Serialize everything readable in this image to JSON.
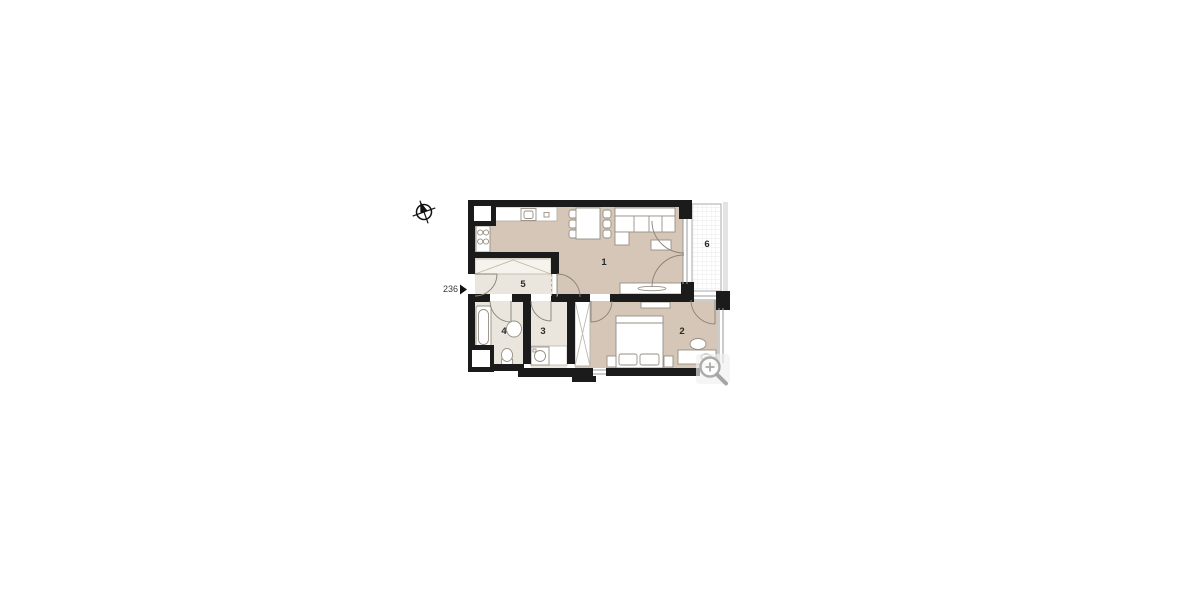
{
  "page": {
    "type": "apartment-floor-plan-viewer",
    "background_color": "#ffffff"
  },
  "floor_plan": {
    "unit_number": "236",
    "entry_marker": "right-filled-triangle",
    "rooms": [
      {
        "label": "1",
        "name": "living-room-with-kitchen"
      },
      {
        "label": "2",
        "name": "bedroom"
      },
      {
        "label": "3",
        "name": "utility-room"
      },
      {
        "label": "4",
        "name": "bathroom"
      },
      {
        "label": "5",
        "name": "hallway"
      },
      {
        "label": "6",
        "name": "balcony"
      }
    ],
    "icons": {
      "compass": "north-compass-crosshair",
      "zoom": "magnifier-plus"
    },
    "colors": {
      "wall": "#1b1b1b",
      "floor_main": "#d5c6b8",
      "floor_light": "#eae5dd",
      "furniture_outline": "#968f84",
      "balcony_grid": "#e4e4e4",
      "label_text": "#2a2a2a",
      "magnifier_gray": "#ababab"
    }
  }
}
